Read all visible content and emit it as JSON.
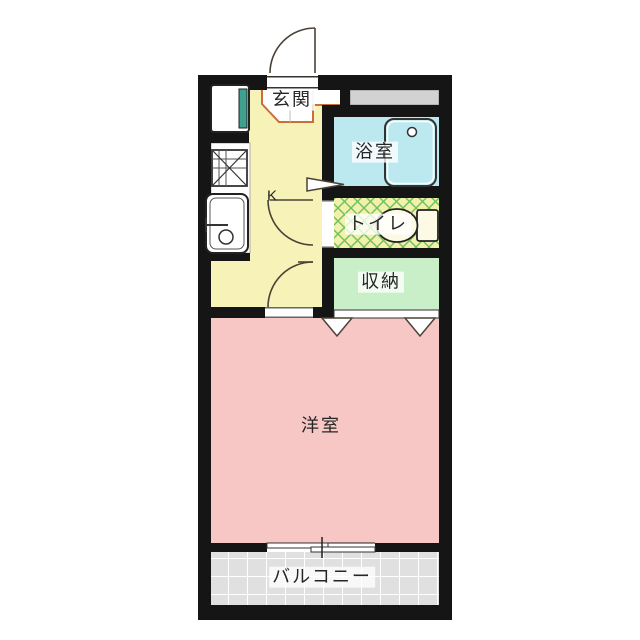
{
  "title": "1K apartment floor plan",
  "rooms": {
    "genkan": {
      "label": "玄関"
    },
    "kitchen": {
      "label": "K"
    },
    "bathroom": {
      "label": "浴室"
    },
    "toilet": {
      "label": "トイレ"
    },
    "storage": {
      "label": "収納"
    },
    "western_room": {
      "label": "洋室"
    },
    "balcony": {
      "label": "バルコニー"
    }
  },
  "icons": {
    "entrance_door": "swing-door-arc",
    "interior_doors": "swing-door-arcs",
    "bathroom_door": "folding-door-triangle",
    "closet_doors": "triangle-markers",
    "bathtub": "bathtub",
    "toilet_fixture": "toilet-bowl-and-tank",
    "sink": "kitchen-sink",
    "stove": "stove-hatch-square",
    "appliance": "appliance-box",
    "window": "sliding-window"
  },
  "colors": {
    "wall": "#151515",
    "kitchen_floor": "#f6f2b8",
    "genkan_floor": "#ffffff",
    "genkan_edge": "#c96f3a",
    "bathroom": "#bce9ef",
    "toilet_floor": "#f3efad",
    "toilet_lattice": "#6cc25a",
    "storage": "#c9efc9",
    "western_room": "#f6c7c4",
    "balcony": "#e0e0e0",
    "balcony_grid": "#ffffff",
    "shaft": "#d2d2d2",
    "appliance_accent": "#3fa08d",
    "door_line": "#4b4237",
    "fixture_fill": "#fcf9e4"
  }
}
